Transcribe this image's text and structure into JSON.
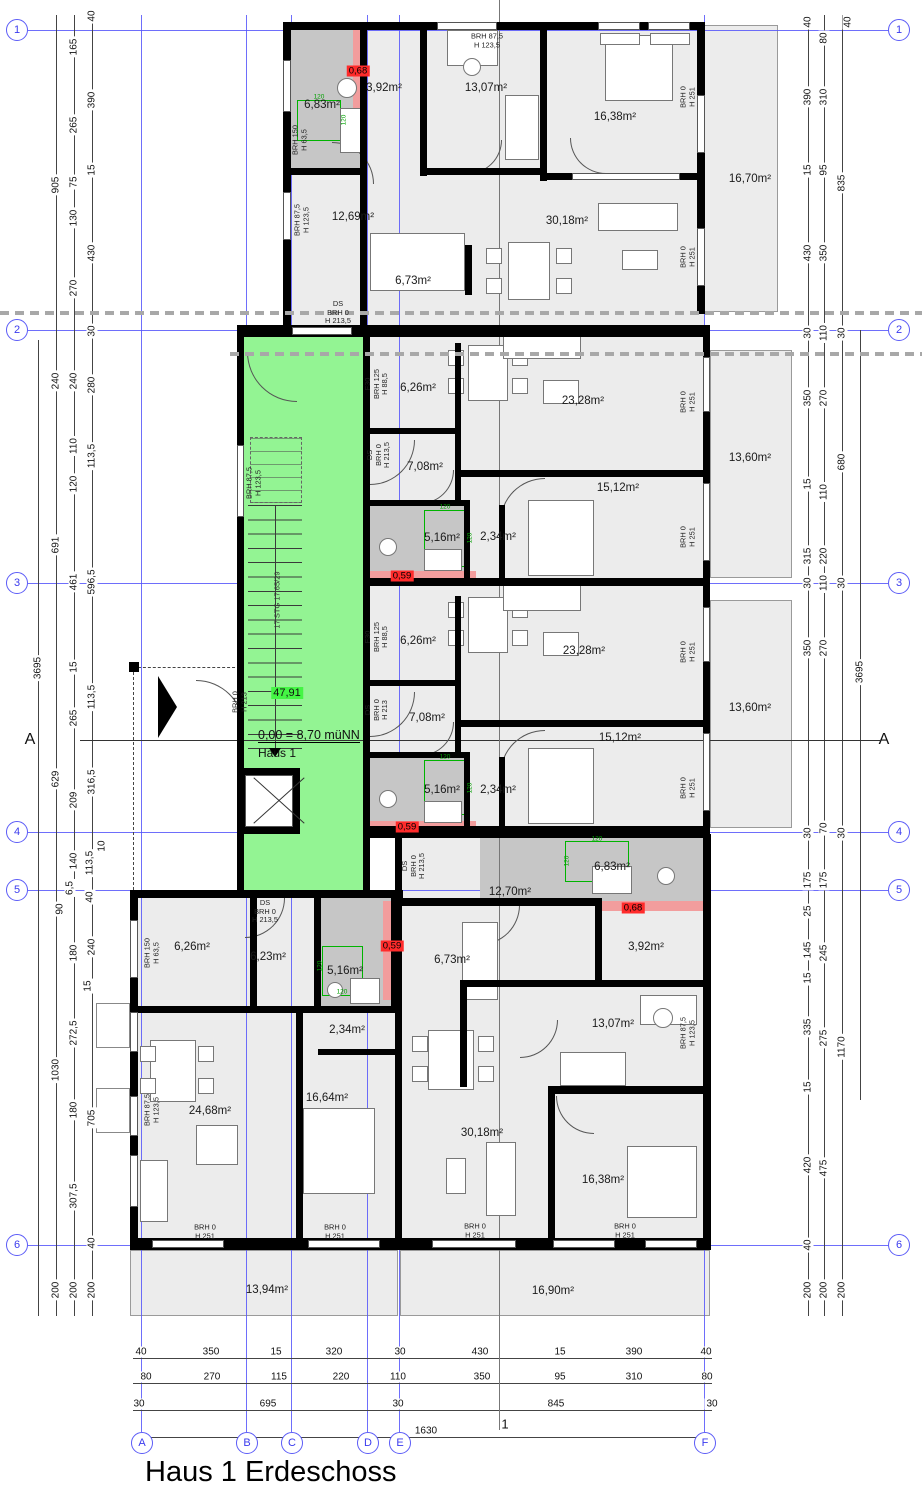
{
  "title": "Haus 1 Erdeschoss",
  "stairwell": {
    "area_label": "47,91",
    "level_label": "0,00 = 8,70 müNN",
    "house_label": "Haus 1",
    "stair_run_label": "17 STG 17,65/29"
  },
  "section": {
    "left": "A",
    "right": "A",
    "bottom": "1"
  },
  "colors": {
    "grid_blue": "#5b5bf7",
    "stair_green": "#93f493",
    "highlight_green": "#44f544",
    "danger_red": "#ff2b2b",
    "band_red": "#f29d9d",
    "bath_gray": "#c6c6c6"
  },
  "grid": {
    "rows": [
      {
        "label": "1",
        "y": 30
      },
      {
        "label": "2",
        "y": 330
      },
      {
        "label": "3",
        "y": 583
      },
      {
        "label": "4",
        "y": 832
      },
      {
        "label": "5",
        "y": 890
      },
      {
        "label": "6",
        "y": 1245
      }
    ],
    "cols": [
      {
        "label": "A",
        "x": 141
      },
      {
        "label": "B",
        "x": 246
      },
      {
        "label": "C",
        "x": 291
      },
      {
        "label": "D",
        "x": 367
      },
      {
        "label": "E",
        "x": 399
      },
      {
        "label": "F",
        "x": 704
      }
    ]
  },
  "room_labels": [
    {
      "text": "6,83m²",
      "x": 322,
      "y": 105
    },
    {
      "text": "3,92m²",
      "x": 384,
      "y": 88
    },
    {
      "text": "13,07m²",
      "x": 486,
      "y": 88
    },
    {
      "text": "16,38m²",
      "x": 615,
      "y": 117
    },
    {
      "text": "16,70m²",
      "x": 750,
      "y": 179
    },
    {
      "text": "12,69m²",
      "x": 353,
      "y": 217
    },
    {
      "text": "30,18m²",
      "x": 567,
      "y": 221
    },
    {
      "text": "6,73m²",
      "x": 413,
      "y": 281
    },
    {
      "text": "6,26m²",
      "x": 418,
      "y": 388
    },
    {
      "text": "23,28m²",
      "x": 583,
      "y": 401
    },
    {
      "text": "7,08m²",
      "x": 425,
      "y": 467
    },
    {
      "text": "5,16m²",
      "x": 442,
      "y": 538
    },
    {
      "text": "2,34m²",
      "x": 498,
      "y": 537
    },
    {
      "text": "15,12m²",
      "x": 618,
      "y": 488
    },
    {
      "text": "13,60m²",
      "x": 750,
      "y": 458
    },
    {
      "text": "6,26m²",
      "x": 418,
      "y": 641
    },
    {
      "text": "23,28m²",
      "x": 584,
      "y": 651
    },
    {
      "text": "7,08m²",
      "x": 427,
      "y": 718
    },
    {
      "text": "5,16m²",
      "x": 442,
      "y": 790
    },
    {
      "text": "2,34m²",
      "x": 498,
      "y": 790
    },
    {
      "text": "15,12m²",
      "x": 620,
      "y": 738
    },
    {
      "text": "13,60m²",
      "x": 750,
      "y": 708
    },
    {
      "text": "6,83m²",
      "x": 612,
      "y": 867
    },
    {
      "text": "12,70m²",
      "x": 510,
      "y": 892
    },
    {
      "text": "6,26m²",
      "x": 192,
      "y": 947
    },
    {
      "text": "6,23m²",
      "x": 268,
      "y": 957
    },
    {
      "text": "5,16m²",
      "x": 345,
      "y": 971
    },
    {
      "text": "3,92m²",
      "x": 646,
      "y": 947
    },
    {
      "text": "6,73m²",
      "x": 452,
      "y": 960
    },
    {
      "text": "2,34m²",
      "x": 347,
      "y": 1030
    },
    {
      "text": "13,07m²",
      "x": 613,
      "y": 1024
    },
    {
      "text": "24,68m²",
      "x": 210,
      "y": 1111
    },
    {
      "text": "16,64m²",
      "x": 327,
      "y": 1098
    },
    {
      "text": "30,18m²",
      "x": 482,
      "y": 1133
    },
    {
      "text": "16,38m²",
      "x": 603,
      "y": 1180
    },
    {
      "text": "13,94m²",
      "x": 267,
      "y": 1290
    },
    {
      "text": "16,90m²",
      "x": 553,
      "y": 1291
    }
  ],
  "wall_notes": [
    {
      "text": "BRH 87,5\nH 123,5",
      "x": 487,
      "y": 41,
      "rot": 0
    },
    {
      "text": "BRH 150\nH 63,5",
      "x": 300,
      "y": 140,
      "rot": -90
    },
    {
      "text": "BRH 87,5\nH 123,5",
      "x": 302,
      "y": 220,
      "rot": -90
    },
    {
      "text": "BRH 0\nH 251",
      "x": 688,
      "y": 97,
      "rot": -90
    },
    {
      "text": "BRH 0\nH 251",
      "x": 688,
      "y": 257,
      "rot": -90
    },
    {
      "text": "DS\nBRH 0\nH 213,5",
      "x": 338,
      "y": 313,
      "rot": 0
    },
    {
      "text": "F30\nBRH 125\nH 88,5",
      "x": 377,
      "y": 384,
      "rot": -90
    },
    {
      "text": "DS\nBRH 0\nH 213,5",
      "x": 379,
      "y": 455,
      "rot": -90
    },
    {
      "text": "BRH 0\nH 251",
      "x": 688,
      "y": 402,
      "rot": -90
    },
    {
      "text": "BRH 0\nH 251",
      "x": 688,
      "y": 537,
      "rot": -90
    },
    {
      "text": "BRH 87,5\nH 123,5",
      "x": 254,
      "y": 483,
      "rot": -90
    },
    {
      "text": "F30\nBRH 125\nH 88,5",
      "x": 377,
      "y": 637,
      "rot": -90
    },
    {
      "text": "DS\nBRH 0\nH 213",
      "x": 377,
      "y": 710,
      "rot": -90
    },
    {
      "text": "BRH 0\nH 251",
      "x": 688,
      "y": 652,
      "rot": -90
    },
    {
      "text": "BRH 0\nH 251",
      "x": 688,
      "y": 788,
      "rot": -90
    },
    {
      "text": "BRH 0\nH 213",
      "x": 240,
      "y": 702,
      "rot": -90
    },
    {
      "text": "DS\nBRH 0\nH 213,5",
      "x": 414,
      "y": 866,
      "rot": -90
    },
    {
      "text": "DS\nBRH 0\nH 213,5",
      "x": 265,
      "y": 912,
      "rot": 0
    },
    {
      "text": "BRH 150\nH 63,5",
      "x": 152,
      "y": 953,
      "rot": -90
    },
    {
      "text": "BRH 87,5\nH 123,5",
      "x": 152,
      "y": 1110,
      "rot": -90
    },
    {
      "text": "BRH 87,5\nH 123,5",
      "x": 688,
      "y": 1033,
      "rot": -90
    },
    {
      "text": "BRH 0\nH 251",
      "x": 205,
      "y": 1232,
      "rot": 0
    },
    {
      "text": "BRH 0\nH 251",
      "x": 335,
      "y": 1232,
      "rot": 0
    },
    {
      "text": "BRH 0\nH 251",
      "x": 475,
      "y": 1231,
      "rot": 0
    },
    {
      "text": "BRH 0\nH 251",
      "x": 625,
      "y": 1231,
      "rot": 0
    }
  ],
  "safety_marks": [
    {
      "text": "0,68",
      "x": 358,
      "y": 71
    },
    {
      "text": "0,59",
      "x": 402,
      "y": 576
    },
    {
      "text": "0,59",
      "x": 407,
      "y": 827
    },
    {
      "text": "0,59",
      "x": 392,
      "y": 946
    },
    {
      "text": "0,68",
      "x": 633,
      "y": 908
    }
  ],
  "shower_dims": [
    {
      "text": "120",
      "x": 319,
      "y": 97,
      "rot": 0
    },
    {
      "text": "120",
      "x": 344,
      "y": 120,
      "rot": -90
    },
    {
      "text": "120",
      "x": 445,
      "y": 507,
      "rot": 0
    },
    {
      "text": "120",
      "x": 470,
      "y": 538,
      "rot": -90
    },
    {
      "text": "120",
      "x": 445,
      "y": 757,
      "rot": 0
    },
    {
      "text": "120",
      "x": 470,
      "y": 788,
      "rot": -90
    },
    {
      "text": "120",
      "x": 342,
      "y": 992,
      "rot": 0
    },
    {
      "text": "120",
      "x": 320,
      "y": 966,
      "rot": -90
    },
    {
      "text": "120",
      "x": 597,
      "y": 839,
      "rot": 0
    },
    {
      "text": "120",
      "x": 567,
      "y": 861,
      "rot": -90
    }
  ],
  "dims": {
    "left": [
      {
        "t": "905",
        "x": 56,
        "y": 185
      },
      {
        "t": "165",
        "x": 74,
        "y": 47
      },
      {
        "t": "265",
        "x": 74,
        "y": 125
      },
      {
        "t": "75",
        "x": 74,
        "y": 182
      },
      {
        "t": "130",
        "x": 74,
        "y": 218
      },
      {
        "t": "270",
        "x": 74,
        "y": 288
      },
      {
        "t": "40",
        "x": 92,
        "y": 16
      },
      {
        "t": "390",
        "x": 92,
        "y": 100
      },
      {
        "t": "15",
        "x": 92,
        "y": 170
      },
      {
        "t": "430",
        "x": 92,
        "y": 253
      },
      {
        "t": "30",
        "x": 92,
        "y": 331
      },
      {
        "t": "240",
        "x": 56,
        "y": 381
      },
      {
        "t": "240",
        "x": 74,
        "y": 381
      },
      {
        "t": "280",
        "x": 92,
        "y": 385
      },
      {
        "t": "110",
        "x": 74,
        "y": 446
      },
      {
        "t": "113,5",
        "x": 92,
        "y": 456
      },
      {
        "t": "120",
        "x": 74,
        "y": 484
      },
      {
        "t": "691",
        "x": 56,
        "y": 545
      },
      {
        "t": "461",
        "x": 74,
        "y": 582
      },
      {
        "t": "596,5",
        "x": 92,
        "y": 582
      },
      {
        "t": "3695",
        "x": 38,
        "y": 668
      },
      {
        "t": "15",
        "x": 74,
        "y": 667
      },
      {
        "t": "113,5",
        "x": 92,
        "y": 697
      },
      {
        "t": "265",
        "x": 74,
        "y": 718
      },
      {
        "t": "629",
        "x": 56,
        "y": 779
      },
      {
        "t": "316,5",
        "x": 92,
        "y": 782
      },
      {
        "t": "209",
        "x": 74,
        "y": 800
      },
      {
        "t": "140",
        "x": 74,
        "y": 861
      },
      {
        "t": "113,5",
        "x": 90,
        "y": 863
      },
      {
        "t": "10",
        "x": 102,
        "y": 846
      },
      {
        "t": "6,5",
        "x": 70,
        "y": 888
      },
      {
        "t": "40",
        "x": 90,
        "y": 897
      },
      {
        "t": "90",
        "x": 60,
        "y": 909
      },
      {
        "t": "240",
        "x": 92,
        "y": 947
      },
      {
        "t": "180",
        "x": 74,
        "y": 953
      },
      {
        "t": "15",
        "x": 88,
        "y": 986
      },
      {
        "t": "272,5",
        "x": 74,
        "y": 1033
      },
      {
        "t": "1030",
        "x": 56,
        "y": 1070
      },
      {
        "t": "180",
        "x": 74,
        "y": 1110
      },
      {
        "t": "705",
        "x": 92,
        "y": 1118
      },
      {
        "t": "307,5",
        "x": 74,
        "y": 1196
      },
      {
        "t": "40",
        "x": 92,
        "y": 1243
      },
      {
        "t": "200",
        "x": 56,
        "y": 1290
      },
      {
        "t": "200",
        "x": 74,
        "y": 1290
      },
      {
        "t": "200",
        "x": 92,
        "y": 1290
      }
    ],
    "right": [
      {
        "t": "40",
        "x": 808,
        "y": 22
      },
      {
        "t": "80",
        "x": 824,
        "y": 38
      },
      {
        "t": "40",
        "x": 848,
        "y": 22
      },
      {
        "t": "390",
        "x": 808,
        "y": 97
      },
      {
        "t": "310",
        "x": 824,
        "y": 97
      },
      {
        "t": "15",
        "x": 808,
        "y": 170
      },
      {
        "t": "95",
        "x": 824,
        "y": 170
      },
      {
        "t": "835",
        "x": 842,
        "y": 183
      },
      {
        "t": "430",
        "x": 808,
        "y": 253
      },
      {
        "t": "350",
        "x": 824,
        "y": 253
      },
      {
        "t": "30",
        "x": 808,
        "y": 333
      },
      {
        "t": "110",
        "x": 824,
        "y": 333
      },
      {
        "t": "30",
        "x": 842,
        "y": 333
      },
      {
        "t": "350",
        "x": 808,
        "y": 398
      },
      {
        "t": "270",
        "x": 824,
        "y": 398
      },
      {
        "t": "15",
        "x": 808,
        "y": 484
      },
      {
        "t": "110",
        "x": 824,
        "y": 492
      },
      {
        "t": "680",
        "x": 842,
        "y": 462
      },
      {
        "t": "315",
        "x": 808,
        "y": 556
      },
      {
        "t": "220",
        "x": 824,
        "y": 556
      },
      {
        "t": "30",
        "x": 808,
        "y": 583
      },
      {
        "t": "110",
        "x": 824,
        "y": 583
      },
      {
        "t": "30",
        "x": 842,
        "y": 583
      },
      {
        "t": "350",
        "x": 808,
        "y": 648
      },
      {
        "t": "270",
        "x": 824,
        "y": 648
      },
      {
        "t": "3695",
        "x": 860,
        "y": 672
      },
      {
        "t": "30",
        "x": 808,
        "y": 833
      },
      {
        "t": "70",
        "x": 824,
        "y": 828
      },
      {
        "t": "30",
        "x": 842,
        "y": 833
      },
      {
        "t": "175",
        "x": 808,
        "y": 880
      },
      {
        "t": "175",
        "x": 824,
        "y": 880
      },
      {
        "t": "25",
        "x": 808,
        "y": 911
      },
      {
        "t": "145",
        "x": 808,
        "y": 950
      },
      {
        "t": "245",
        "x": 824,
        "y": 953
      },
      {
        "t": "15",
        "x": 808,
        "y": 978
      },
      {
        "t": "335",
        "x": 808,
        "y": 1027
      },
      {
        "t": "275",
        "x": 824,
        "y": 1038
      },
      {
        "t": "1170",
        "x": 842,
        "y": 1047
      },
      {
        "t": "15",
        "x": 808,
        "y": 1087
      },
      {
        "t": "420",
        "x": 808,
        "y": 1165
      },
      {
        "t": "475",
        "x": 824,
        "y": 1168
      },
      {
        "t": "40",
        "x": 808,
        "y": 1245
      },
      {
        "t": "200",
        "x": 808,
        "y": 1290
      },
      {
        "t": "200",
        "x": 824,
        "y": 1290
      },
      {
        "t": "200",
        "x": 842,
        "y": 1290
      }
    ],
    "bottom": [
      {
        "t": "40",
        "x": 141,
        "y": 1352
      },
      {
        "t": "350",
        "x": 211,
        "y": 1352
      },
      {
        "t": "15",
        "x": 276,
        "y": 1352
      },
      {
        "t": "320",
        "x": 334,
        "y": 1352
      },
      {
        "t": "30",
        "x": 400,
        "y": 1352
      },
      {
        "t": "430",
        "x": 480,
        "y": 1352
      },
      {
        "t": "15",
        "x": 560,
        "y": 1352
      },
      {
        "t": "390",
        "x": 634,
        "y": 1352
      },
      {
        "t": "40",
        "x": 706,
        "y": 1352
      },
      {
        "t": "80",
        "x": 146,
        "y": 1377
      },
      {
        "t": "270",
        "x": 212,
        "y": 1377
      },
      {
        "t": "115",
        "x": 279,
        "y": 1377
      },
      {
        "t": "220",
        "x": 341,
        "y": 1377
      },
      {
        "t": "110",
        "x": 398,
        "y": 1377
      },
      {
        "t": "350",
        "x": 482,
        "y": 1377
      },
      {
        "t": "95",
        "x": 560,
        "y": 1377
      },
      {
        "t": "310",
        "x": 634,
        "y": 1377
      },
      {
        "t": "80",
        "x": 707,
        "y": 1377
      },
      {
        "t": "30",
        "x": 139,
        "y": 1404
      },
      {
        "t": "695",
        "x": 268,
        "y": 1404
      },
      {
        "t": "30",
        "x": 398,
        "y": 1404
      },
      {
        "t": "845",
        "x": 556,
        "y": 1404
      },
      {
        "t": "30",
        "x": 712,
        "y": 1404
      },
      {
        "t": "1630",
        "x": 426,
        "y": 1431
      }
    ]
  }
}
